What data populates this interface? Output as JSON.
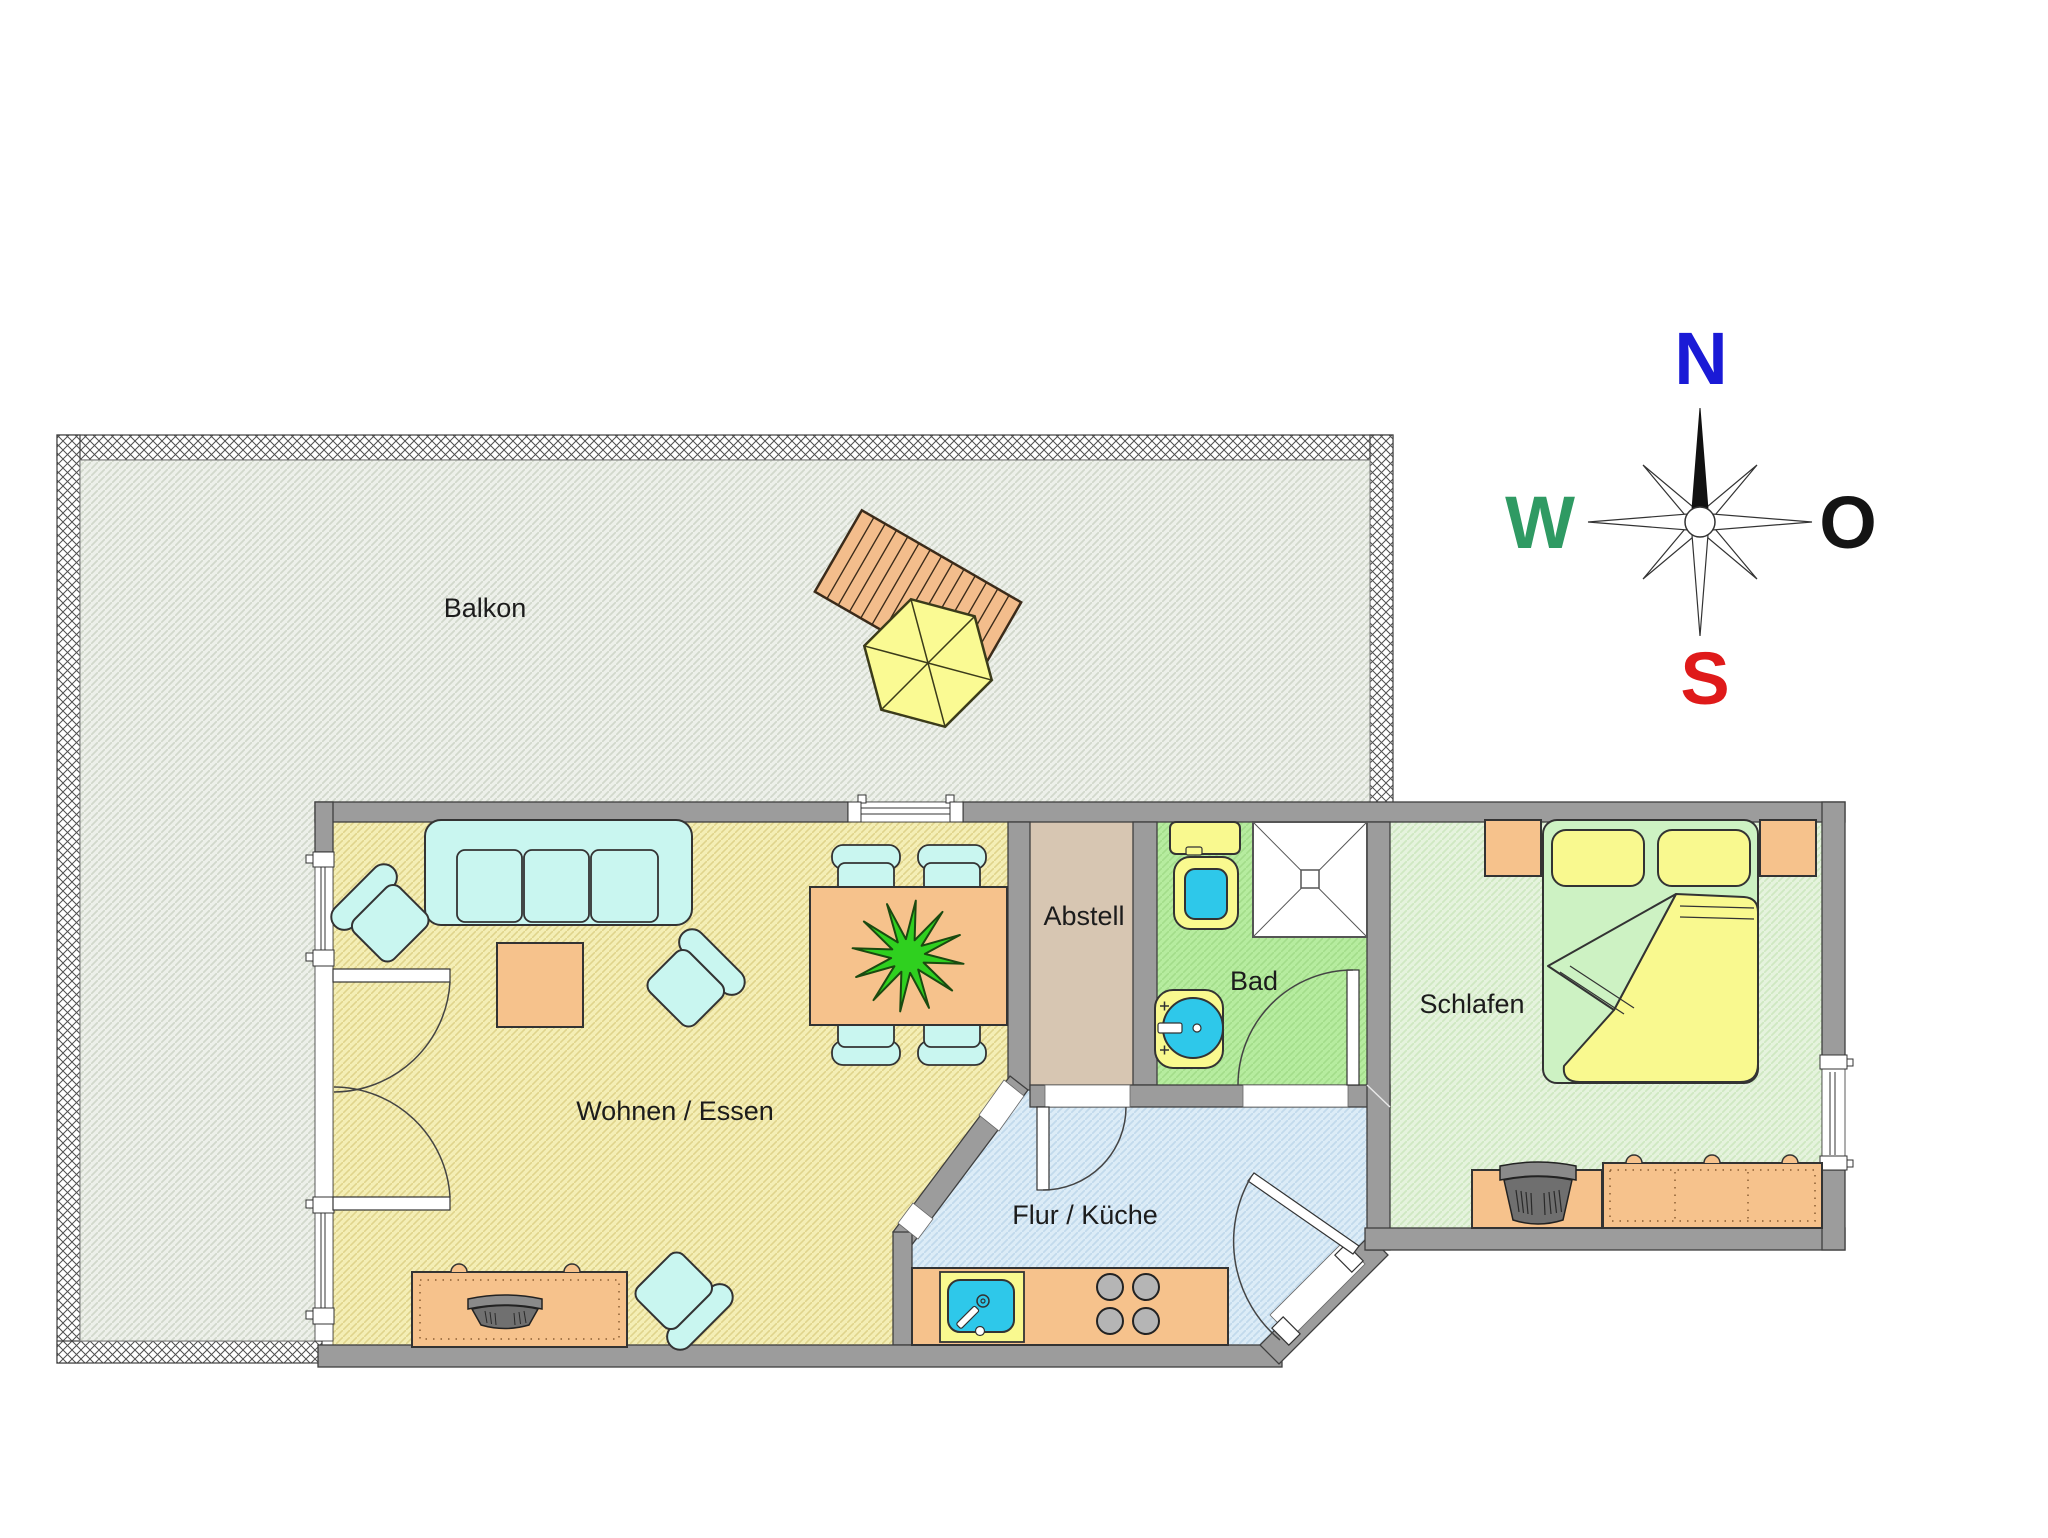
{
  "document": {
    "type": "apartment-floor-plan",
    "background": "#ffffff"
  },
  "rooms": [
    {
      "id": "balkon",
      "label": "Balkon"
    },
    {
      "id": "wohnen-essen",
      "label": "Wohnen / Essen"
    },
    {
      "id": "abstell",
      "label": "Abstell"
    },
    {
      "id": "bad",
      "label": "Bad"
    },
    {
      "id": "schlafen",
      "label": "Schlafen"
    },
    {
      "id": "flur-kueche",
      "label": "Flur / Küche"
    }
  ],
  "compass": {
    "north": "N",
    "east": "O",
    "south": "S",
    "west": "W",
    "colors": {
      "north": "#1a1ad6",
      "east": "#141414",
      "south": "#df1a1a",
      "west": "#2f9a63"
    }
  },
  "palette": {
    "wall_gray": "#9c9c9c",
    "upholstery_cyan": "#c9f6f0",
    "wood_orange": "#f6c28c",
    "fixture_yellow": "#f9f98f",
    "water_cyan": "#2ec8ea",
    "bed_linen_green": "#cdf2c3",
    "plant_green": "#2fd01f",
    "floor_balcony": "#edf0ea",
    "floor_living": "#f4eeb5",
    "floor_abstell": "#d7c6b2",
    "floor_bad": "#b6ec9f",
    "floor_schlafen": "#e5f3dd",
    "floor_flur": "#dcecf7"
  }
}
